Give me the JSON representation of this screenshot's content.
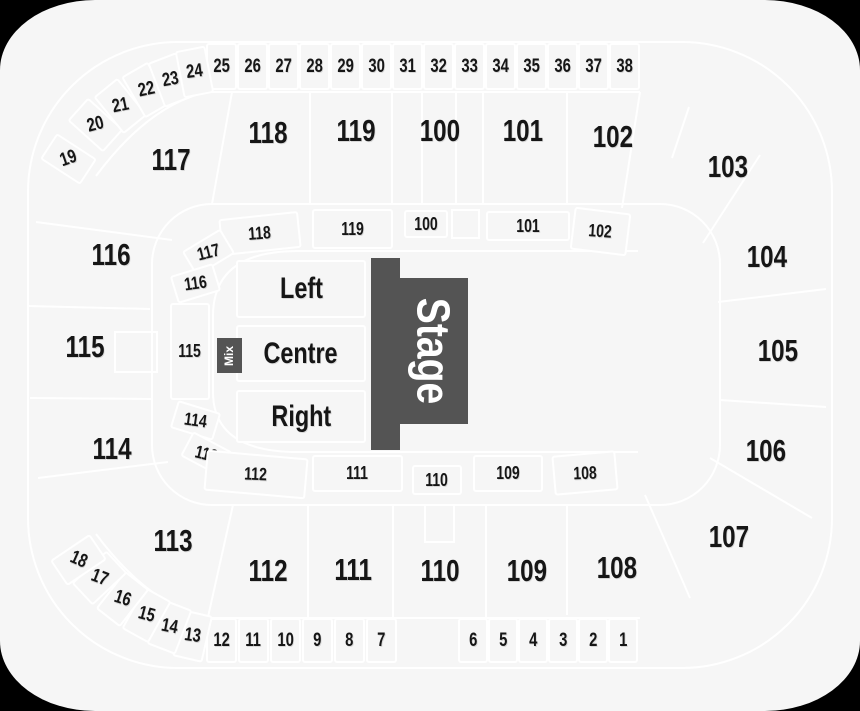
{
  "colors": {
    "background": "#f6f6f6",
    "section_line": "#ffffff",
    "label_text": "#161616",
    "stage_fill": "#545454",
    "stage_text": "#ffffff",
    "outside_corner": "#000000"
  },
  "stage": {
    "label": "Stage"
  },
  "mix": {
    "label": "Mix"
  },
  "sections": {
    "floor": {
      "left": "Left",
      "centre": "Centre",
      "right": "Right"
    },
    "outer": {
      "100": "100",
      "101": "101",
      "102": "102",
      "103": "103",
      "104": "104",
      "105": "105",
      "106": "106",
      "107": "107",
      "108": "108",
      "109": "109",
      "110": "110",
      "111": "111",
      "112": "112",
      "113": "113",
      "114": "114",
      "115": "115",
      "116": "116",
      "117": "117",
      "118": "118",
      "119": "119"
    },
    "inner": {
      "100": "100",
      "101": "101",
      "102": "102",
      "108": "108",
      "109": "109",
      "110": "110",
      "111": "111",
      "112": "112",
      "113": "113",
      "114": "114",
      "115": "115",
      "116": "116",
      "117": "117",
      "118": "118",
      "119": "119"
    },
    "small": {
      "1": "1",
      "2": "2",
      "3": "3",
      "4": "4",
      "5": "5",
      "6": "6",
      "7": "7",
      "8": "8",
      "9": "9",
      "10": "10",
      "11": "11",
      "12": "12",
      "13": "13",
      "14": "14",
      "15": "15",
      "16": "16",
      "17": "17",
      "18": "18",
      "19": "19",
      "20": "20",
      "21": "21",
      "22": "22",
      "23": "23",
      "24": "24",
      "25": "25",
      "26": "26",
      "27": "27",
      "28": "28",
      "29": "29",
      "30": "30",
      "31": "31",
      "32": "32",
      "33": "33",
      "34": "34",
      "35": "35",
      "36": "36",
      "37": "37",
      "38": "38"
    }
  }
}
